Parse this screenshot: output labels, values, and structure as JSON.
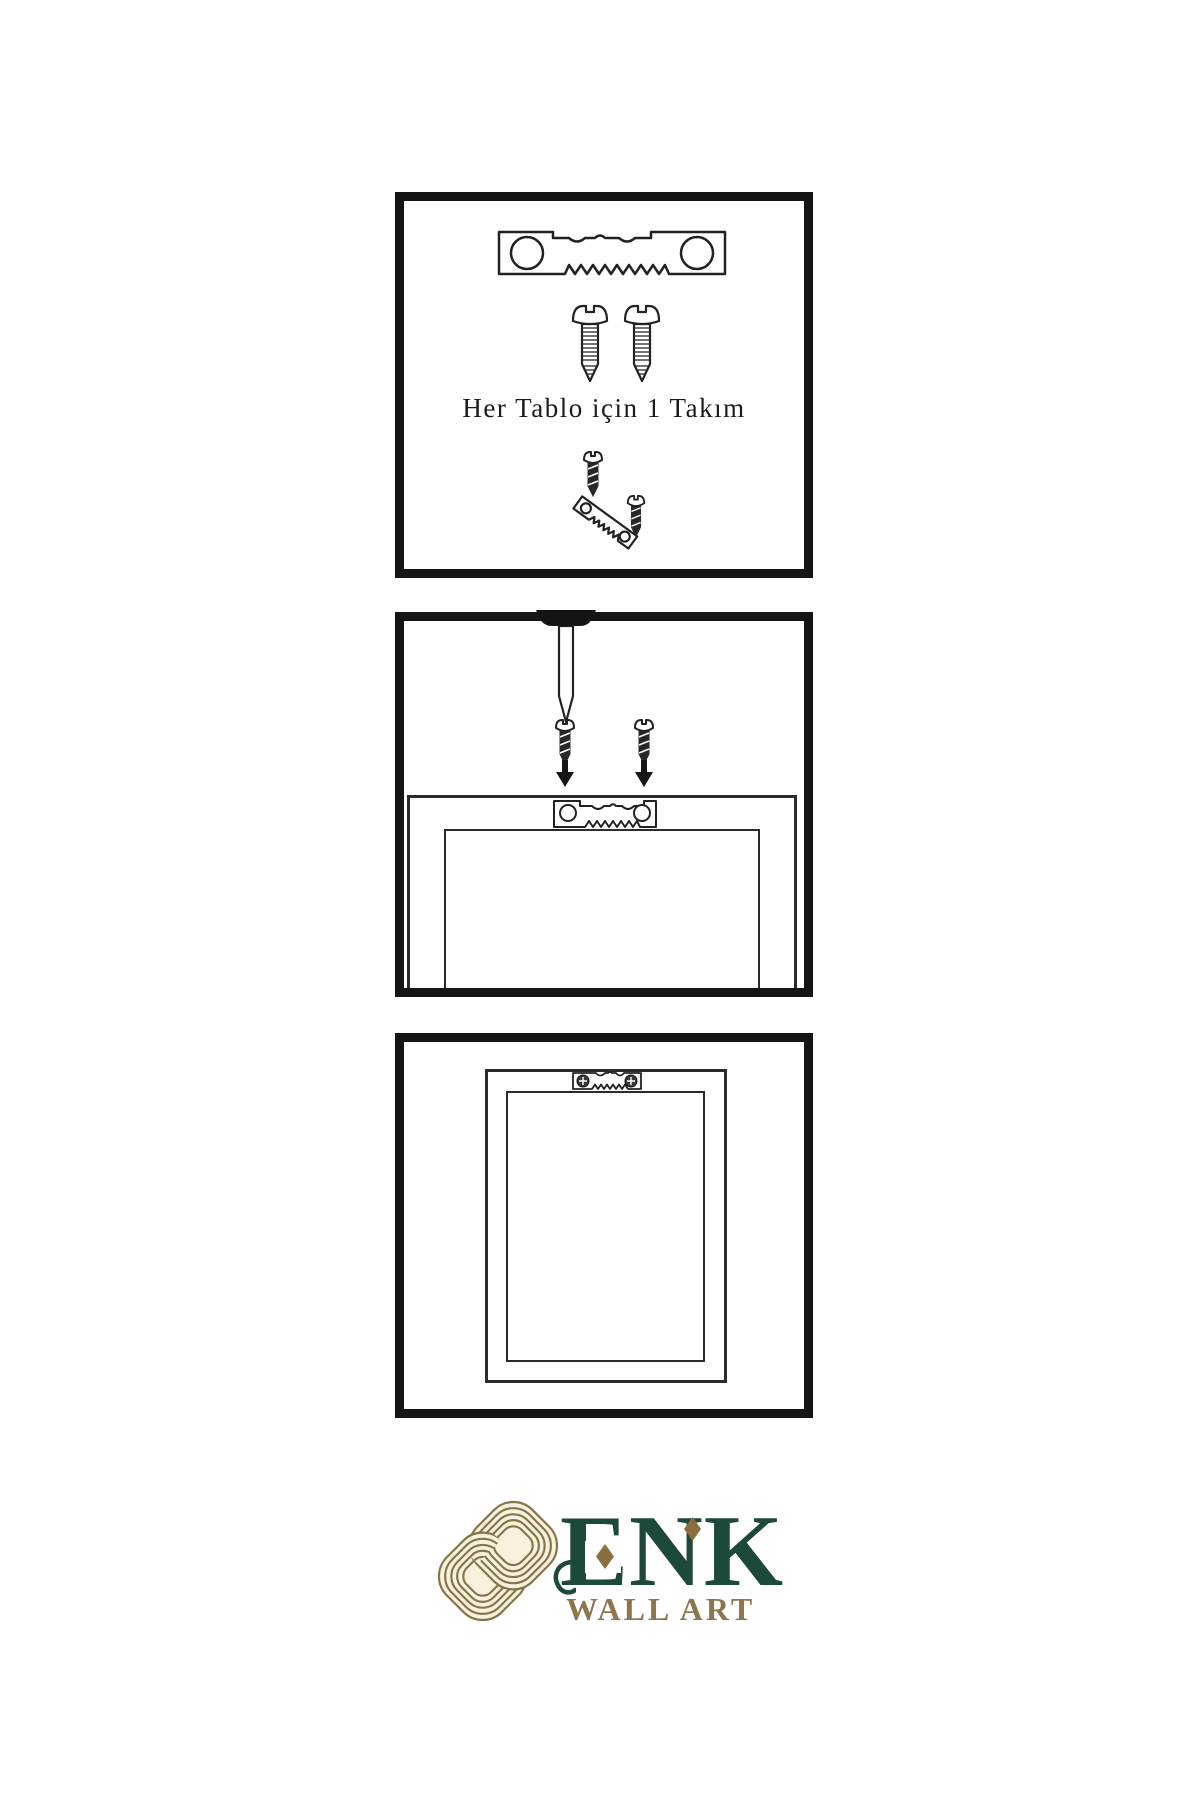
{
  "caption": {
    "panel1": "Her Tablo için 1 Takım"
  },
  "logo": {
    "title": "ENK",
    "subtitle": "WALL ART"
  },
  "colors": {
    "ink": "#1f1f1f",
    "panel_border": "#151515",
    "screw_dark": "#282828",
    "logo_green": "#1d4938",
    "logo_gold": "#8a6f3e",
    "logo_subtitle_gold": "#8c764e",
    "knot_line": "#857549",
    "knot_fill": "#f8f1de",
    "background": "#ffffff"
  },
  "icons": [
    "sawtooth-hanger-icon",
    "screw-icon",
    "dark-screw-icon",
    "nail-icon",
    "down-arrow-icon",
    "frame-back-icon",
    "hanging-frame-icon",
    "knot-logo-icon",
    "diamond-accent-icon"
  ]
}
